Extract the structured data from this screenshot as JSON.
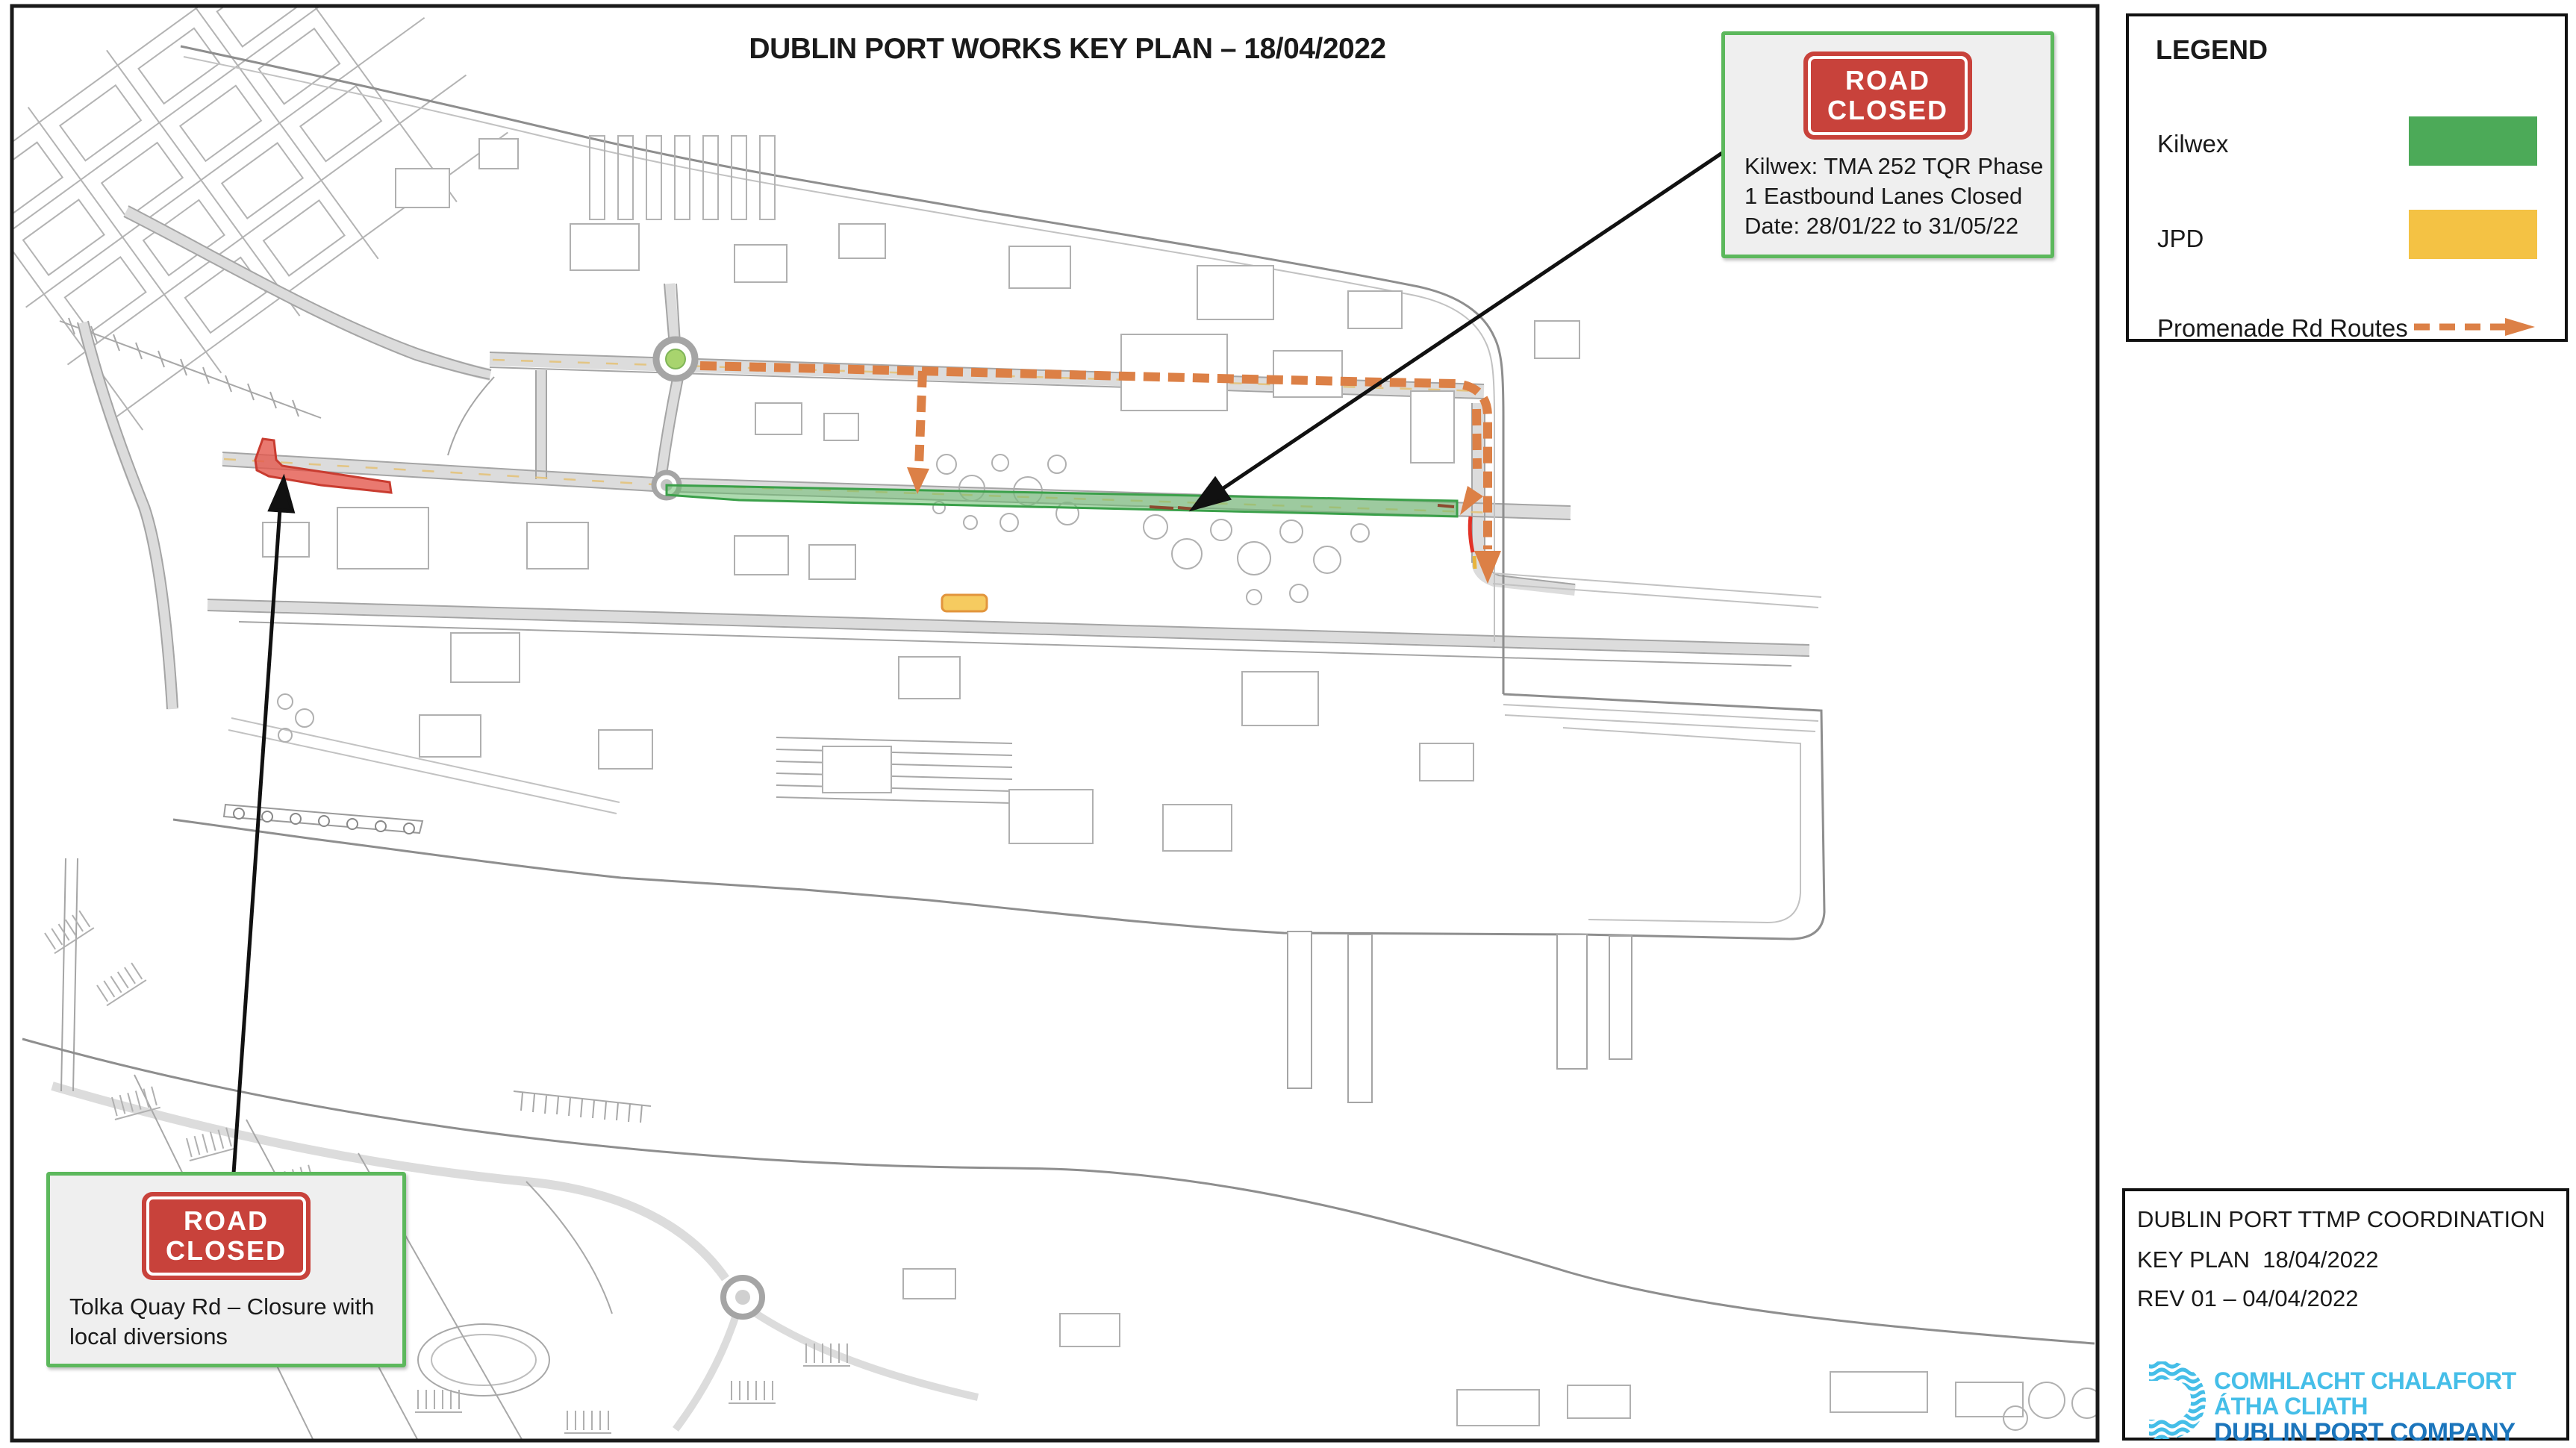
{
  "map_title": "DUBLIN PORT WORKS KEY PLAN – 18/04/2022",
  "legend": {
    "heading": "LEGEND",
    "items": [
      {
        "label": "Kilwex",
        "swatch": "#4CAA58"
      },
      {
        "label": "JPD",
        "swatch": "#F4C244"
      },
      {
        "label": "Promenade Rd Routes",
        "swatch": "#DC8046"
      }
    ]
  },
  "callout_kilwex": {
    "sign_line1": "ROAD",
    "sign_line2": "CLOSED",
    "body_line1": "Kilwex: TMA 252 TQR Phase",
    "body_line2": "1 Eastbound Lanes Closed",
    "body_line3": "Date: 28/01/22 to 31/05/22"
  },
  "callout_tolka": {
    "sign_line1": "ROAD",
    "sign_line2": "CLOSED",
    "body_line1": "Tolka Quay Rd – Closure with",
    "body_line2": "local diversions"
  },
  "title_block": {
    "line1": "DUBLIN PORT TTMP COORDINATION",
    "line2": "KEY PLAN  18/04/2022",
    "line3": "REV 01 – 04/04/2022",
    "logo_line1": "COMHLACHT CHALAFORT",
    "logo_line2": "ÁTHA CLIATH",
    "logo_line3": "DUBLIN PORT COMPANY"
  },
  "overlay_colors": {
    "tolka_closure_red": "#E4584C",
    "kilwex_route_green": "#4CAA58",
    "jpd_marker_yellow": "#F4C244",
    "promenade_route_orange": "#DC8046",
    "road_sign_red": "#C8423B",
    "callout_border_green": "#5CB85C"
  }
}
